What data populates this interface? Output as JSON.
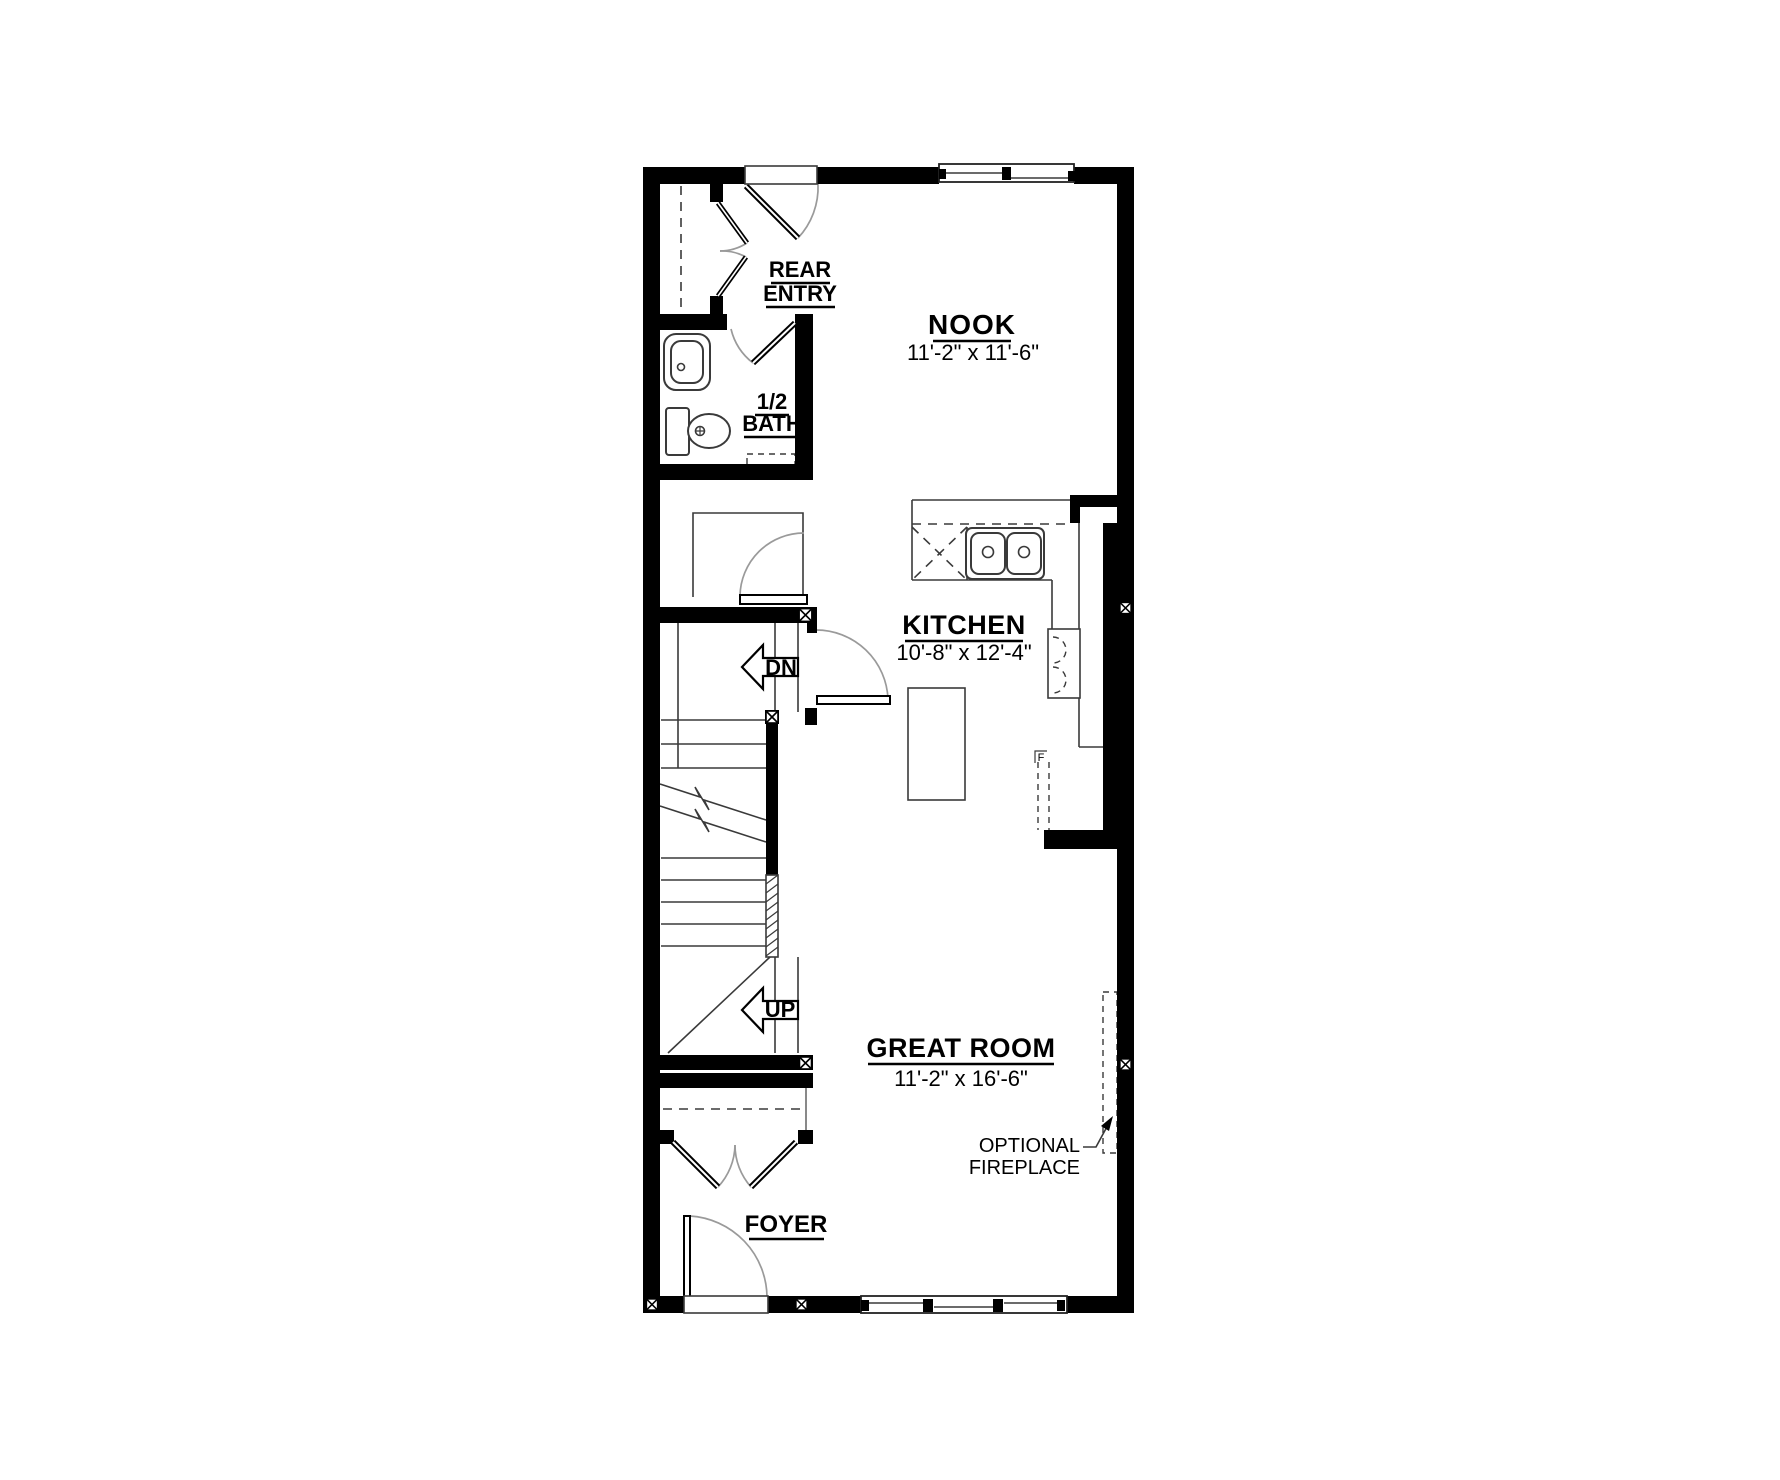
{
  "floor_plan": {
    "rooms": {
      "rear_entry": {
        "line1": "REAR",
        "line2": "ENTRY"
      },
      "half_bath": {
        "line1": "1/2",
        "line2": "BATH"
      },
      "nook": {
        "name": "NOOK",
        "dims": "11'-2\" x 11'-6\""
      },
      "kitchen": {
        "name": "KITCHEN",
        "dims": "10'-8\" x 12'-4\""
      },
      "great_room": {
        "name": "GREAT ROOM",
        "dims": "11'-2\" x 16'-6\""
      },
      "foyer": {
        "name": "FOYER"
      }
    },
    "stairs": {
      "down_label": "DN",
      "up_label": "UP"
    },
    "annotations": {
      "fireplace_line1": "OPTIONAL",
      "fireplace_line2": "FIREPLACE",
      "marker_f": "F"
    },
    "colors": {
      "walls": "#000000",
      "thin_lines": "#3a3a3a",
      "door_swings": "#9a9a9a",
      "background": "#ffffff"
    }
  }
}
